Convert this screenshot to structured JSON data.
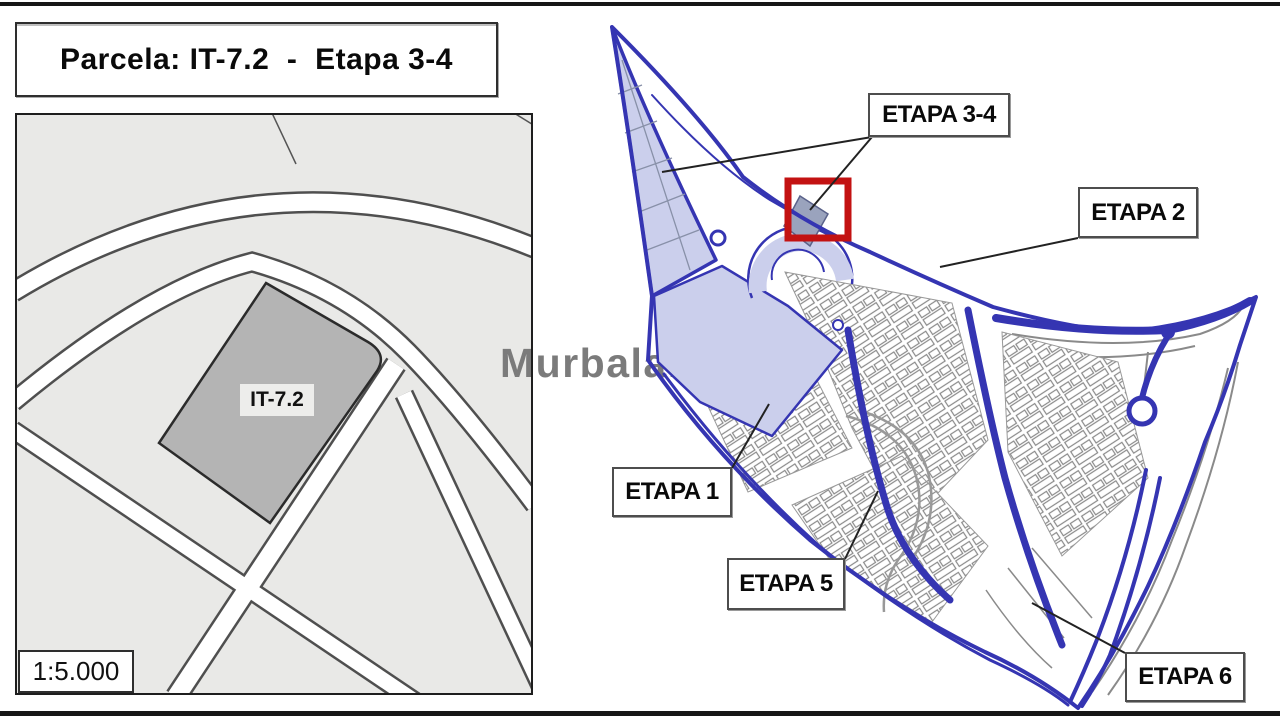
{
  "header": {
    "title": "Parcela: IT-7.2  -  Etapa 3-4"
  },
  "watermark": {
    "text": "Murbalands ®"
  },
  "detail_map": {
    "parcel_label": "IT-7.2",
    "scale_label": "1:5.000"
  },
  "overview_map": {
    "stage_labels": [
      {
        "text": "ETAPA 3-4"
      },
      {
        "text": "ETAPA 2"
      },
      {
        "text": "ETAPA 1"
      },
      {
        "text": "ETAPA 5"
      },
      {
        "text": "ETAPA 6"
      }
    ]
  },
  "colors": {
    "plan_blue": "#3535b2",
    "stage_fill_lavender": "#cbcfec",
    "highlight_red": "#c31212",
    "parcel_gray": "#b4b4b4",
    "watermark_gray": "#7b7b7b"
  }
}
